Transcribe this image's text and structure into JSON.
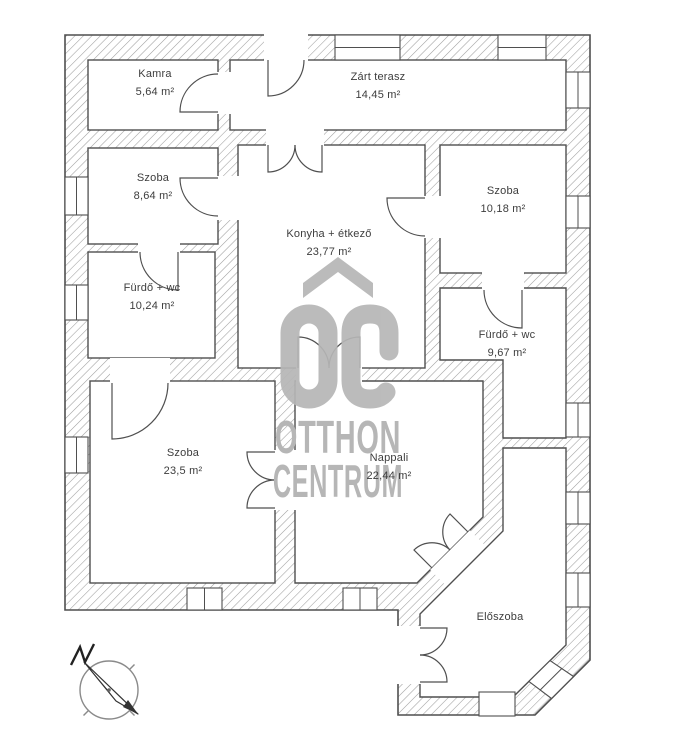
{
  "plan": {
    "rooms": [
      {
        "name": "Kamra",
        "area": "5,64 m²"
      },
      {
        "name": "Zárt terasz",
        "area": "14,45 m²"
      },
      {
        "name": "Szoba",
        "area": "8,64 m²"
      },
      {
        "name": "Konyha + étkező",
        "area": "23,77 m²"
      },
      {
        "name": "Szoba",
        "area": "10,18 m²"
      },
      {
        "name": "Fürdő + wc",
        "area": "10,24 m²"
      },
      {
        "name": "Fürdő + wc",
        "area": "9,67 m²"
      },
      {
        "name": "Szoba",
        "area": "23,5 m²"
      },
      {
        "name": "Nappali",
        "area": "22,44 m²"
      },
      {
        "name": "Előszoba",
        "area": ""
      }
    ]
  },
  "watermark": {
    "logo_icon": "oc-house-logo",
    "logo_text": "OC",
    "line1": "OTTHON",
    "line2": "CENTRUM",
    "color": "#b6b6b6"
  },
  "compass": {
    "icon": "north-compass-arrow"
  },
  "colors": {
    "wall_outline": "#4f4f4f",
    "hatch": "#9e9e9e",
    "room_fill": "#ffffff",
    "label_text": "#3d3d3d"
  }
}
